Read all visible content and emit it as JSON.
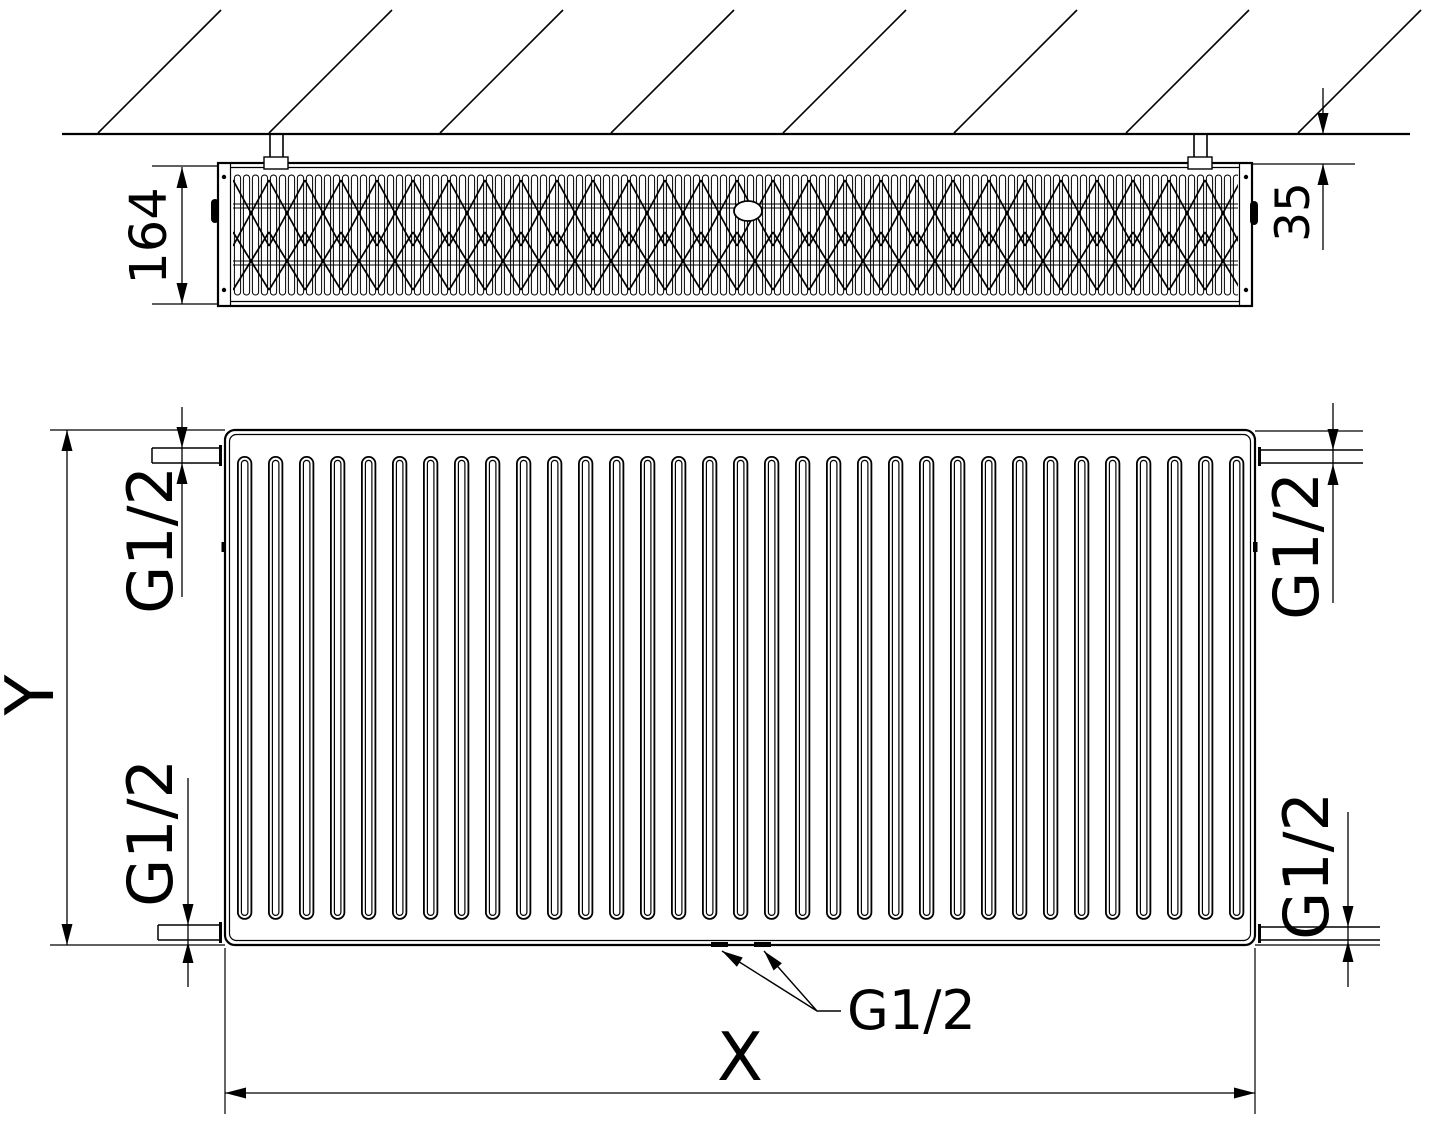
{
  "colors": {
    "line": "#000000",
    "background": "#ffffff"
  },
  "top_view": {
    "depth_label": "164",
    "wall_gap_label": "35"
  },
  "front_view": {
    "height_label": "Y",
    "width_label": "X",
    "connections": {
      "top_left": "G1/2",
      "top_right": "G1/2",
      "bottom_left": "G1/2",
      "bottom_right": "G1/2",
      "bottom_center": "G1/2"
    }
  }
}
